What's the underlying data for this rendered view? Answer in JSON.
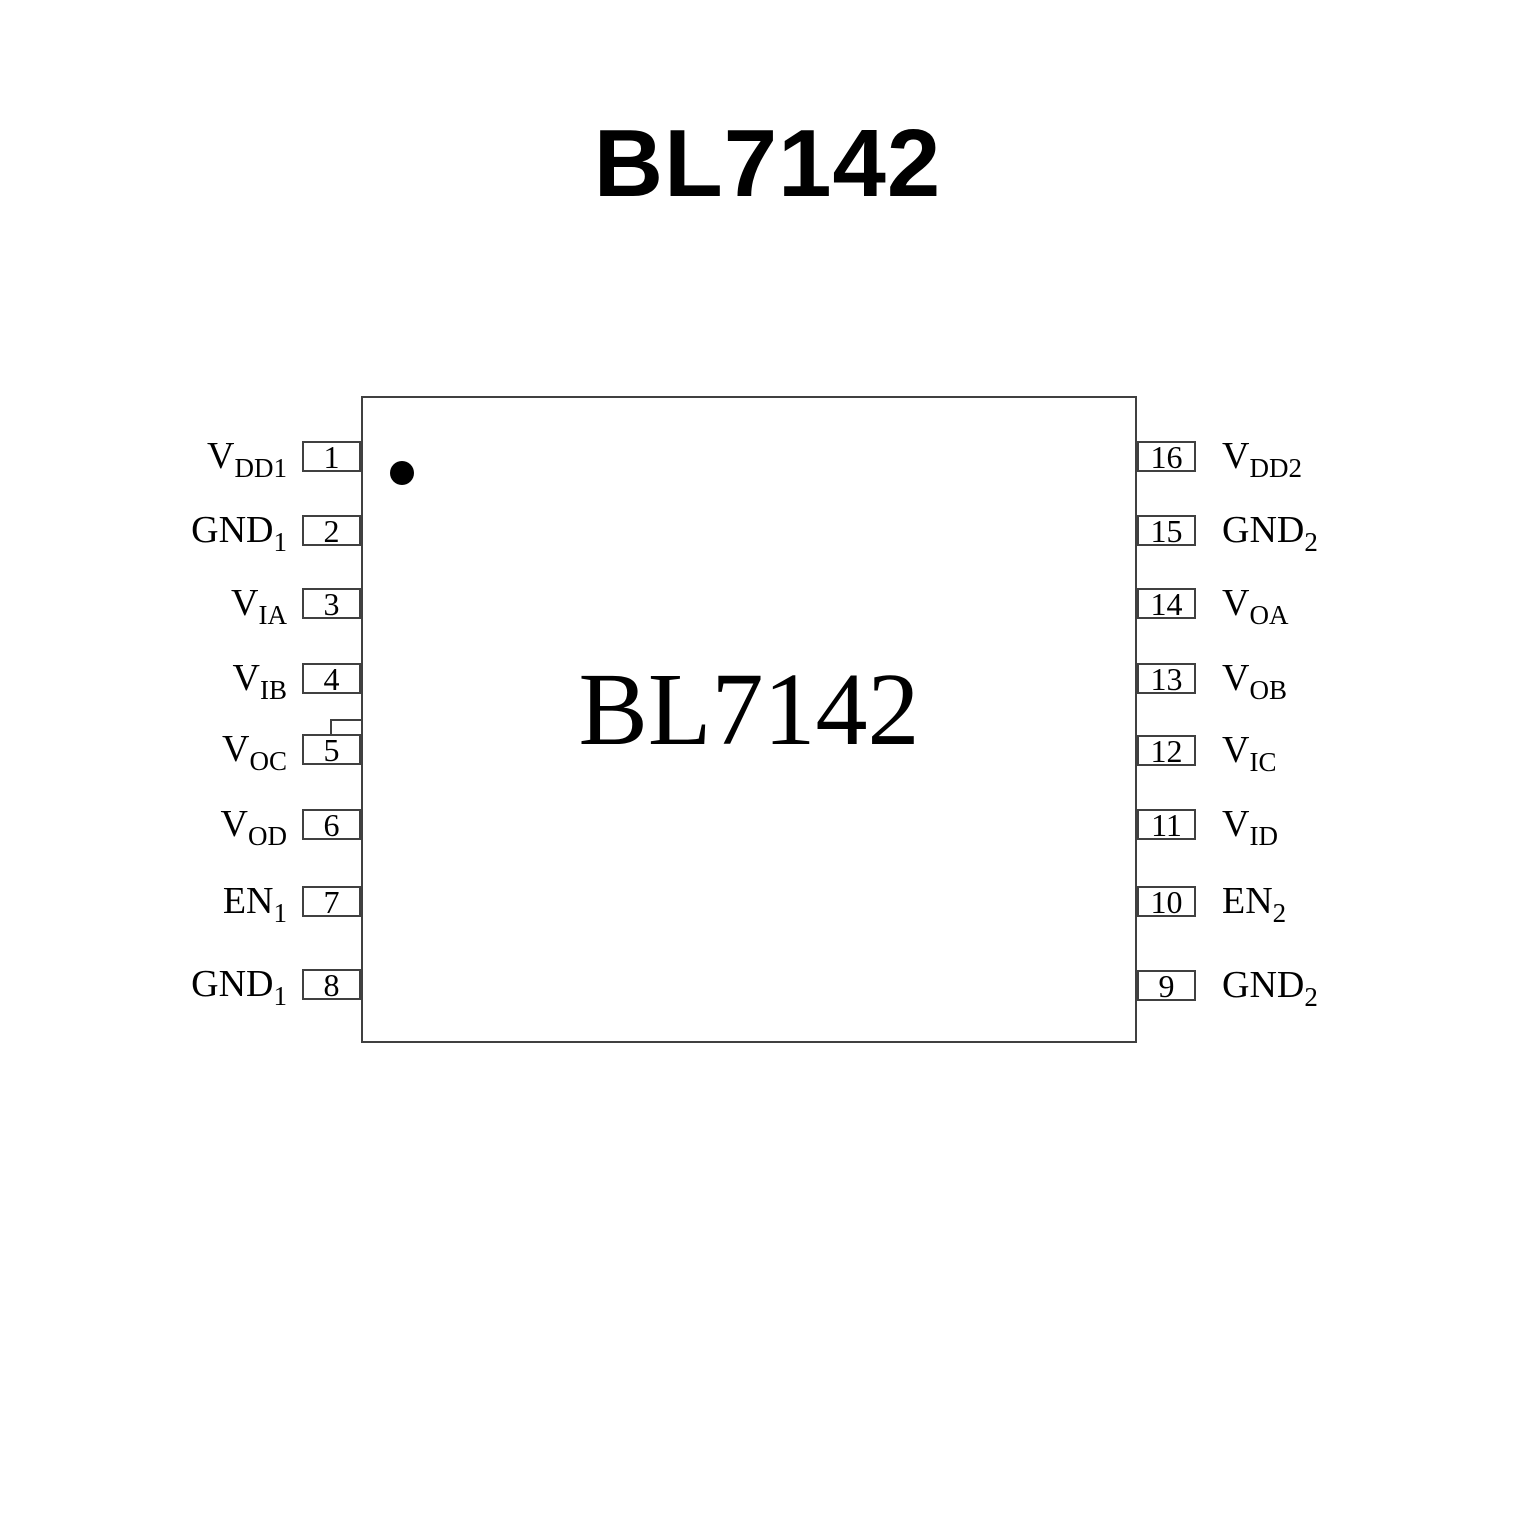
{
  "page": {
    "title": "BL7142"
  },
  "colors": {
    "background": "#ffffff",
    "ink": "#000000",
    "outline": "#404040"
  },
  "chip": {
    "label": "BL7142",
    "pin1_marker": "black-dot"
  },
  "pins": {
    "left": [
      {
        "number": "1",
        "base": "V",
        "sub": "DD1"
      },
      {
        "number": "2",
        "base": "GND",
        "sub": "1"
      },
      {
        "number": "3",
        "base": "V",
        "sub": "IA"
      },
      {
        "number": "4",
        "base": "V",
        "sub": "IB"
      },
      {
        "number": "5",
        "base": "V",
        "sub": "OC"
      },
      {
        "number": "6",
        "base": "V",
        "sub": "OD"
      },
      {
        "number": "7",
        "base": "EN",
        "sub": "1"
      },
      {
        "number": "8",
        "base": "GND",
        "sub": "1"
      }
    ],
    "right": [
      {
        "number": "16",
        "base": "V",
        "sub": "DD2"
      },
      {
        "number": "15",
        "base": "GND",
        "sub": "2"
      },
      {
        "number": "14",
        "base": "V",
        "sub": "OA"
      },
      {
        "number": "13",
        "base": "V",
        "sub": "OB"
      },
      {
        "number": "12",
        "base": "V",
        "sub": "IC"
      },
      {
        "number": "11",
        "base": "V",
        "sub": "ID"
      },
      {
        "number": "10",
        "base": "EN",
        "sub": "2"
      },
      {
        "number": "9",
        "base": "GND",
        "sub": "2"
      }
    ]
  }
}
